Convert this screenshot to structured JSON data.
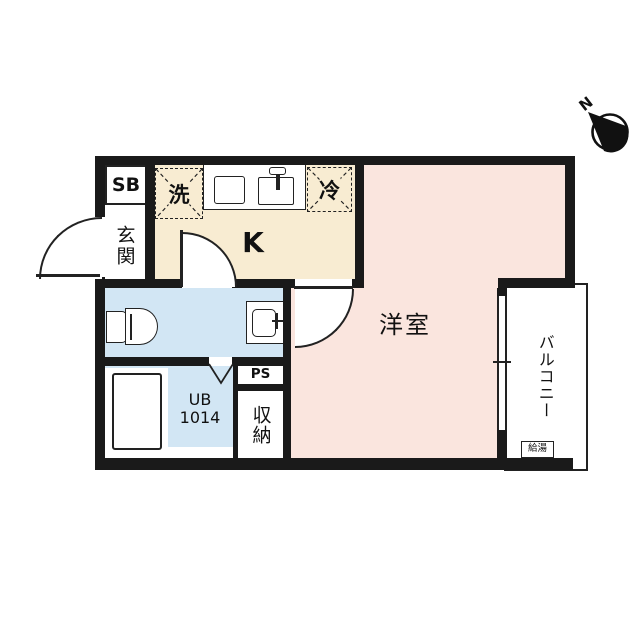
{
  "compass": {
    "north_label": "N"
  },
  "rooms": {
    "shoe_box": "SB",
    "entrance": "玄関",
    "kitchen": "K",
    "washer_place": "洗",
    "refrigerator_place": "冷",
    "western_room": "洋室",
    "balcony": "バルコニー",
    "water_heater": "給湯",
    "unit_bath_line1": "UB",
    "unit_bath_line2": "1014",
    "pipe_space": "PS",
    "storage": "収納"
  },
  "colors": {
    "wall": "#1a1a1a",
    "kitchen_fill": "#f8ecd2",
    "wet_area_fill": "#d2e6f4",
    "room_fill": "#fae5de",
    "balcony_fill": "#ffffff",
    "background": "#ffffff"
  }
}
